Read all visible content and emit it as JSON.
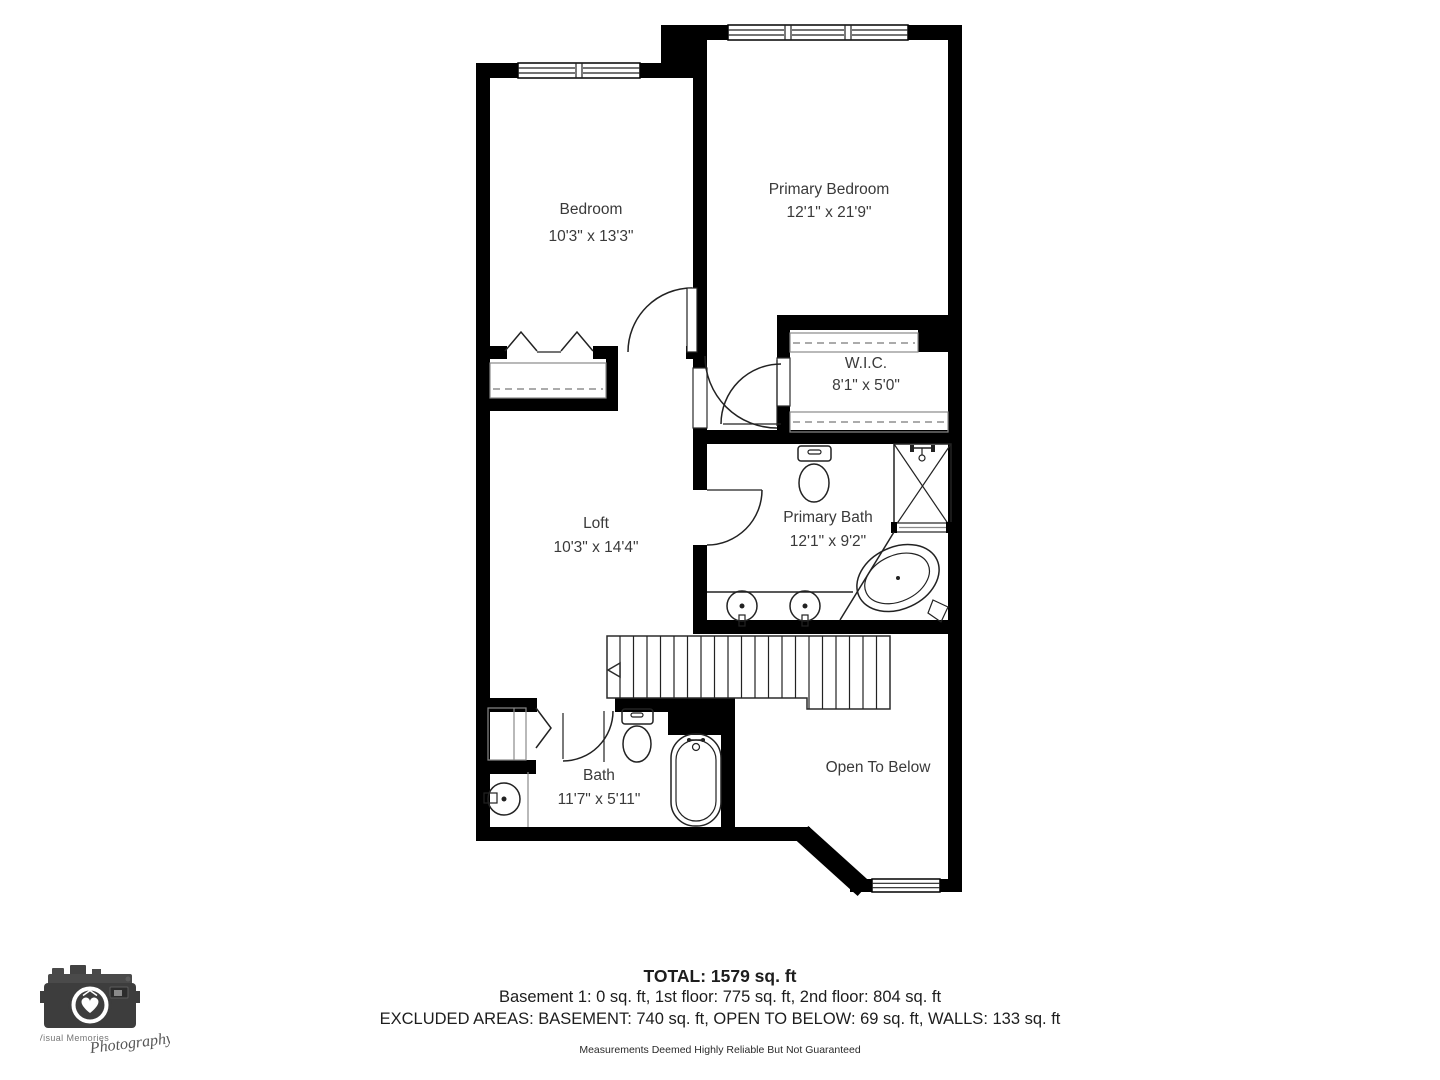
{
  "plan": {
    "rooms": [
      {
        "name": "Bedroom",
        "dims": "10'3\" x 13'3\""
      },
      {
        "name": "Primary Bedroom",
        "dims": "12'1\" x 21'9\""
      },
      {
        "name": "W.I.C.",
        "dims": "8'1\" x 5'0\""
      },
      {
        "name": "Loft",
        "dims": "10'3\" x 14'4\""
      },
      {
        "name": "Primary Bath",
        "dims": "12'1\" x 9'2\""
      },
      {
        "name": "Bath",
        "dims": "11'7\" x 5'11\""
      },
      {
        "name": "Open To Below",
        "dims": ""
      }
    ]
  },
  "footer": {
    "total": "TOTAL: 1579 sq. ft",
    "floors": "Basement 1: 0 sq. ft, 1st floor: 775 sq. ft, 2nd floor: 804 sq. ft",
    "excluded": "EXCLUDED AREAS: BASEMENT: 740 sq. ft, OPEN TO BELOW: 69 sq. ft, WALLS: 133 sq. ft",
    "disclaimer": "Measurements Deemed Highly Reliable But Not Guaranteed"
  },
  "logo": {
    "line1": "Visual Memories",
    "line2": "Photography"
  },
  "colors": {
    "wall": "#000000",
    "label_text": "#3a3a3a",
    "shelf_line": "#8f8f8f"
  }
}
